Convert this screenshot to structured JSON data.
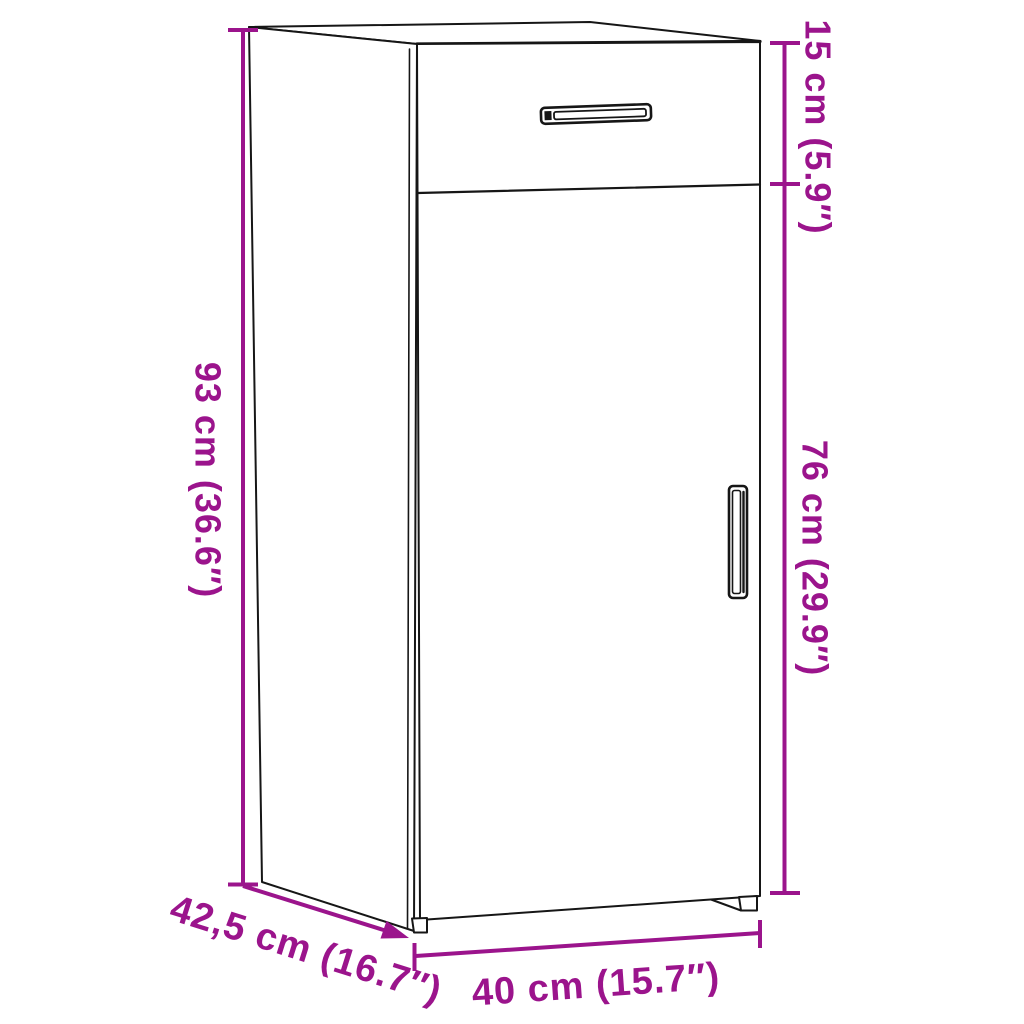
{
  "diagram": {
    "kind": "furniture-dimension-diagram",
    "subject": "cabinet with one drawer and one door, three-quarter line-art view",
    "colors": {
      "background": "#ffffff",
      "outline": "#161616",
      "dimension_accent": "#9B148C"
    },
    "dimensions": {
      "overall_height": {
        "cm": "93",
        "inches": "36.6",
        "label": "93 cm (36.6″)"
      },
      "drawer_section_height": {
        "cm": "15",
        "inches": "5.9",
        "label": "15 cm (5.9″)"
      },
      "door_section_height": {
        "cm": "76",
        "inches": "29.9",
        "label": "76 cm (29.9″)"
      },
      "width": {
        "cm": "40",
        "inches": "15.7",
        "label": "40 cm (15.7″)"
      },
      "depth": {
        "cm": "42,5",
        "inches": "16.7",
        "label": "42,5 cm (16.7″)"
      }
    }
  }
}
